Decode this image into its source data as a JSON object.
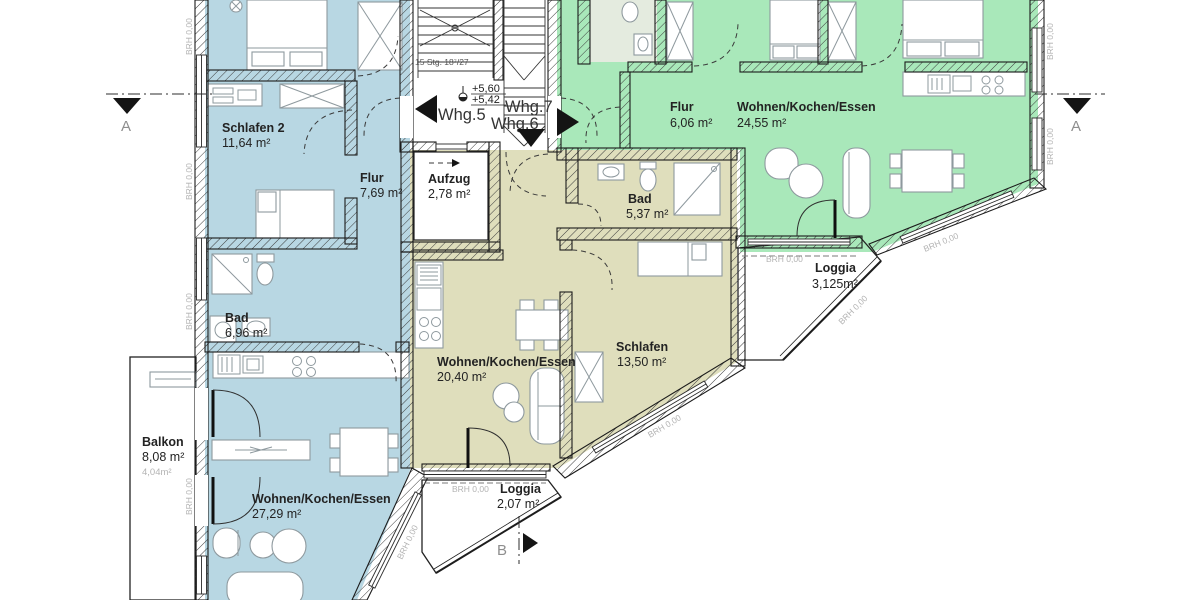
{
  "colors": {
    "blue": "#b8d7e3",
    "balcony": "#cfe4ee",
    "beige": "#dfdebc",
    "green": "#a9e8ba",
    "bath": "#e4ebdf"
  },
  "brh": "BRH 0,00",
  "stair_note": "15 Stg. 18⁷/27",
  "levels": {
    "upper": "+5,60",
    "lower": "+5,42"
  },
  "markers": {
    "section_a": "A",
    "section_b": "B"
  },
  "core": {
    "aufzug": {
      "name": "Aufzug",
      "area": "2,78 m²"
    }
  },
  "units": {
    "whg5": {
      "name": "Whg.5",
      "rooms": {
        "schlafen2": {
          "name": "Schlafen 2",
          "area": "11,64 m²"
        },
        "flur": {
          "name": "Flur",
          "area": "7,69 m²"
        },
        "bad": {
          "name": "Bad",
          "area": "6,96 m²"
        },
        "wohnen": {
          "name": "Wohnen/Kochen/Essen",
          "area": "27,29 m²"
        },
        "balkon": {
          "name": "Balkon",
          "area": "8,08 m²",
          "area_half": "4,04m²"
        }
      }
    },
    "whg6": {
      "name": "Whg.6",
      "rooms": {
        "bad": {
          "name": "Bad",
          "area": "5,37 m²"
        },
        "wohnen": {
          "name": "Wohnen/Kochen/Essen",
          "area": "20,40 m²"
        },
        "schlafen": {
          "name": "Schlafen",
          "area": "13,50 m²"
        },
        "loggia": {
          "name": "Loggia",
          "area": "2,07 m²"
        }
      }
    },
    "whg7": {
      "name": "Whg.7",
      "rooms": {
        "flur": {
          "name": "Flur",
          "area": "6,06 m²"
        },
        "wohnen": {
          "name": "Wohnen/Kochen/Essen",
          "area": "24,55 m²"
        },
        "loggia": {
          "name": "Loggia",
          "area": "3,125m²"
        }
      }
    }
  }
}
